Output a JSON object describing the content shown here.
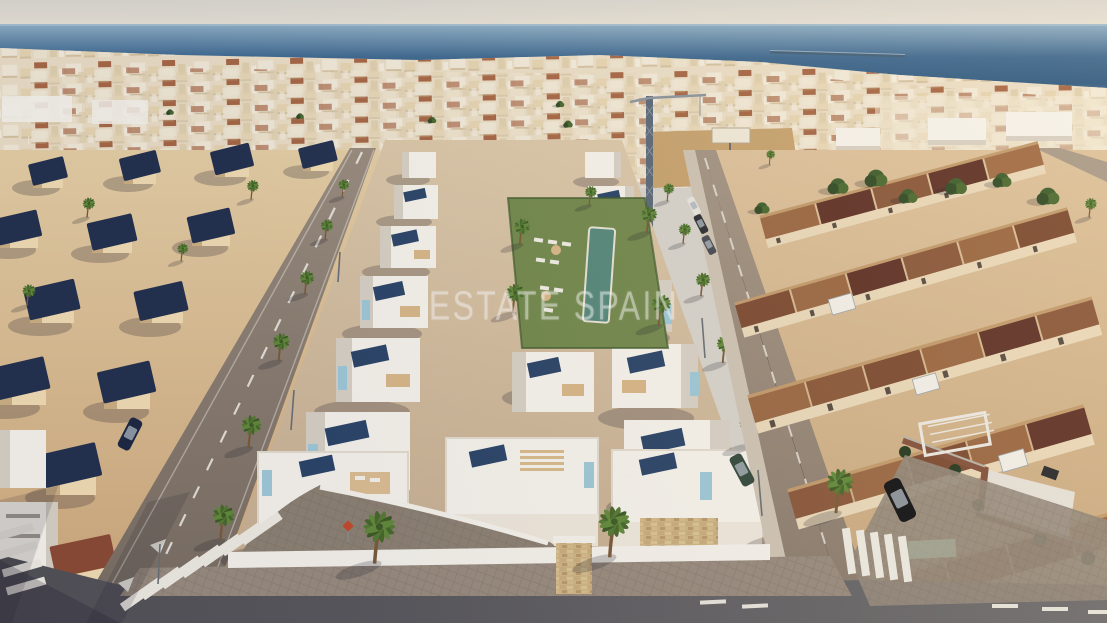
{
  "watermark": {
    "text": "ESTATE SPAIN"
  },
  "scene": {
    "type": "aerial-photograph",
    "elements": [
      "sky",
      "sea-horizon",
      "breakwater",
      "beachfront-town",
      "construction-crane",
      "billboard",
      "new-build-white-villas",
      "rooftop-solar-panels",
      "communal-pool-garden",
      "sun-loungers",
      "palm-lined-streets",
      "navy-roof-villas",
      "terracotta-roof-townhouses",
      "brick-garden-walls",
      "asphalt-roads",
      "zebra-crosswalks",
      "road-markings",
      "parked-cars",
      "sidewalk-pavers",
      "stone-clad-wall"
    ]
  },
  "palette": {
    "sky_top": "#dcd9d1",
    "sky_bottom": "#eae4d8",
    "sea_top": "#8fb0c7",
    "sea_mid": "#3d6890",
    "sea_bottom": "#52789b",
    "far_town": "#ecdfc7",
    "terracotta": "#a3613e",
    "sand_light": "#e6cfa5",
    "sand_dark": "#cfa87a",
    "villa_cream": "#f2ddb2",
    "roof_navy": "#22304f",
    "white_wall": "#f7f4ed",
    "white_shade": "#d8d1c5",
    "solar_panel": "#2a4468",
    "accent_blue": "#9fc9d8",
    "lawn": "#72894c",
    "pool": "#55897b",
    "roof_terracotta": "#9a6742",
    "roof_dark_maroon": "#5e3126",
    "townhouse_wall": "#ead9ba",
    "road_light": "#9a8c7e",
    "road_dark": "#58575b",
    "sidewalk": "#998b7e",
    "palm_green": "#557a32",
    "trunk_brown": "#7a5a38",
    "shadow": "rgba(28,26,42,0.24)",
    "watermark_white": "#ffffff"
  }
}
